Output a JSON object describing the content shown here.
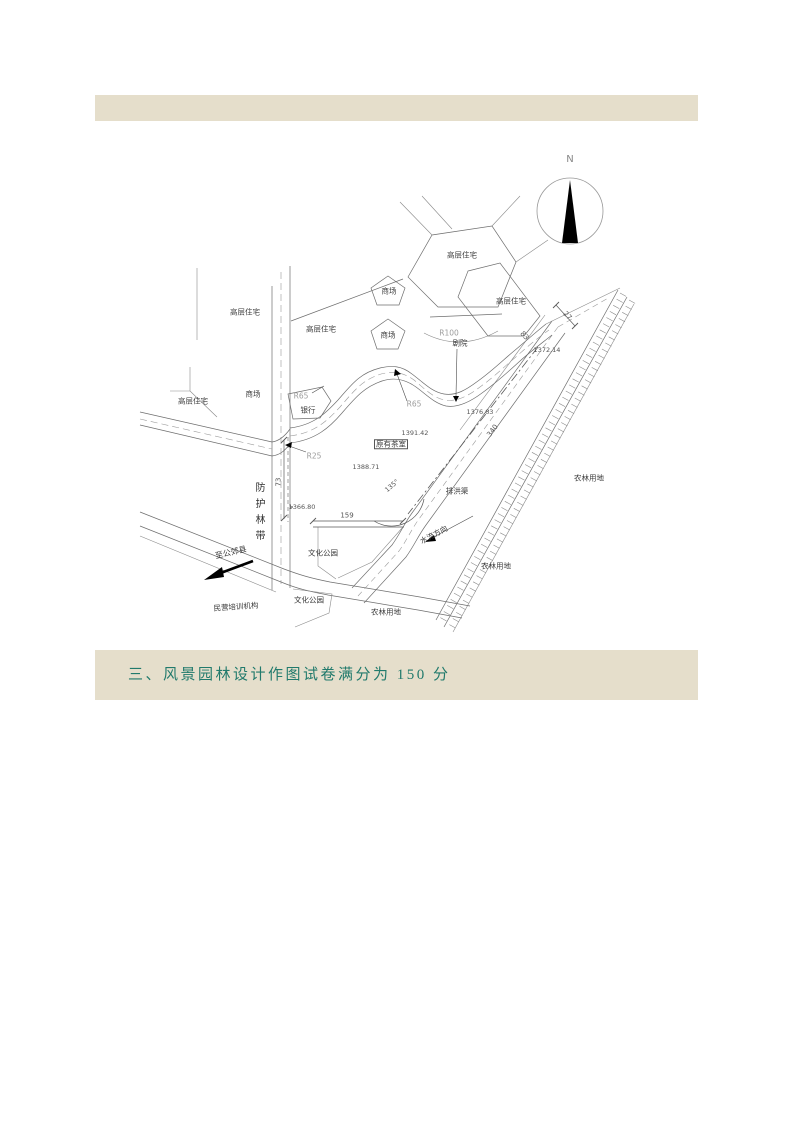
{
  "banner": {
    "heading": "三、风景园林设计作图试卷满分为 150 分"
  },
  "plan": {
    "north": "N",
    "labels": {
      "residential": "高层住宅",
      "market": "商场",
      "bank": "银行",
      "theater": "剧院",
      "tea_house": "原有茶室",
      "culture_park": "文化公园",
      "training_org": "民营培训机构",
      "farmland": "农林用地",
      "shelter_belt": "防护林带",
      "drainage_channel": "排洪渠",
      "water_flow": "水流方向",
      "to_county": "至公郊县"
    },
    "radii": {
      "r100": "R100",
      "r65": "R65",
      "r25": "R25"
    },
    "elevations": {
      "ev1391": "1391.42",
      "ev1388": "1388.71",
      "ev1376": "1376.63",
      "ev1366": "1366.80",
      "ev1372": "1372.14"
    },
    "dimensions": {
      "d159": "159",
      "d340": "340",
      "d73": "73",
      "d27": "27",
      "d83": "83",
      "a135": "135°"
    }
  },
  "colors": {
    "band": "#e5decb",
    "banner_text": "#217a6c",
    "line": "#6e6e6e"
  }
}
